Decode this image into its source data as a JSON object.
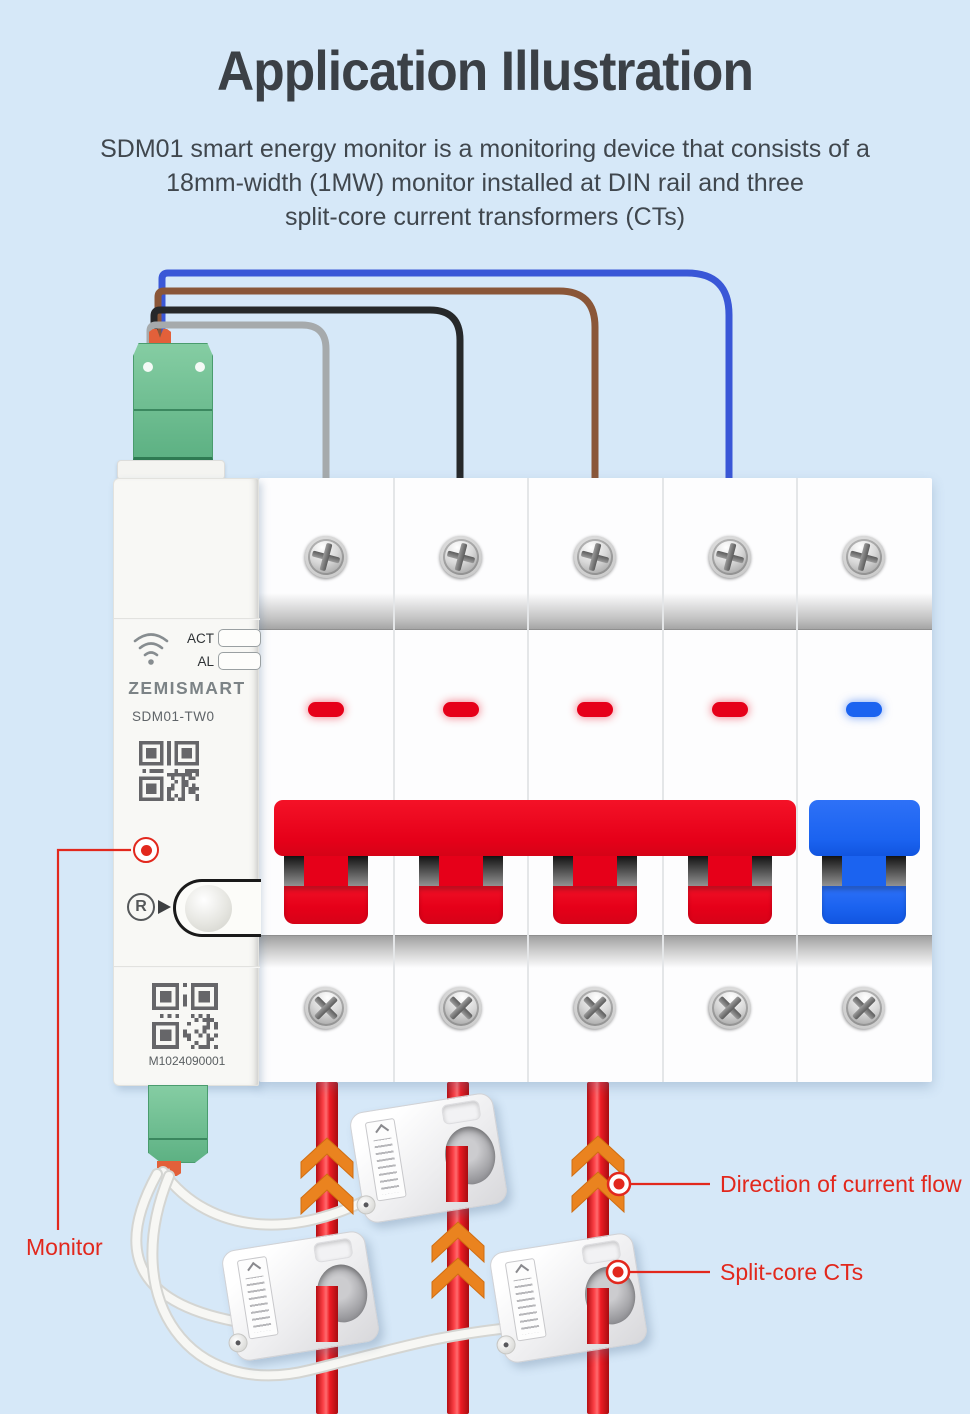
{
  "page": {
    "title": "Application Illustration",
    "description_lines": [
      "SDM01 smart energy monitor is a monitoring device that consists of a",
      "18mm-width (1MW) monitor installed at DIN rail and three",
      "split-core current transformers (CTs)"
    ]
  },
  "monitor": {
    "brand": "ZEMISMART",
    "model": "SDM01-TW0",
    "led_labels": [
      "ACT",
      "AL"
    ],
    "reset_label": "R",
    "serial": "M1024090001"
  },
  "callouts": {
    "monitor": "Monitor",
    "direction": "Direction of current flow",
    "split_core": "Split-core CTs"
  },
  "colors": {
    "background": "#d6e8f8",
    "accent_red": "#e2281d",
    "cable_red": "#ed1c24",
    "breaker_red": "#e60019",
    "breaker_blue": "#1b63f0",
    "arrow_orange": "#ea831f",
    "terminal_green": "#6fc08f",
    "wire_blue": "#3a57d7",
    "wire_brown": "#8a5638",
    "wire_gray": "#a6aaac",
    "wire_black": "#26282a"
  },
  "icons": {
    "wifi": "wifi-icon",
    "qr": "qr-code",
    "screw": "screw-icon",
    "reset": "reset-button",
    "arrow": "current-direction-arrow"
  }
}
